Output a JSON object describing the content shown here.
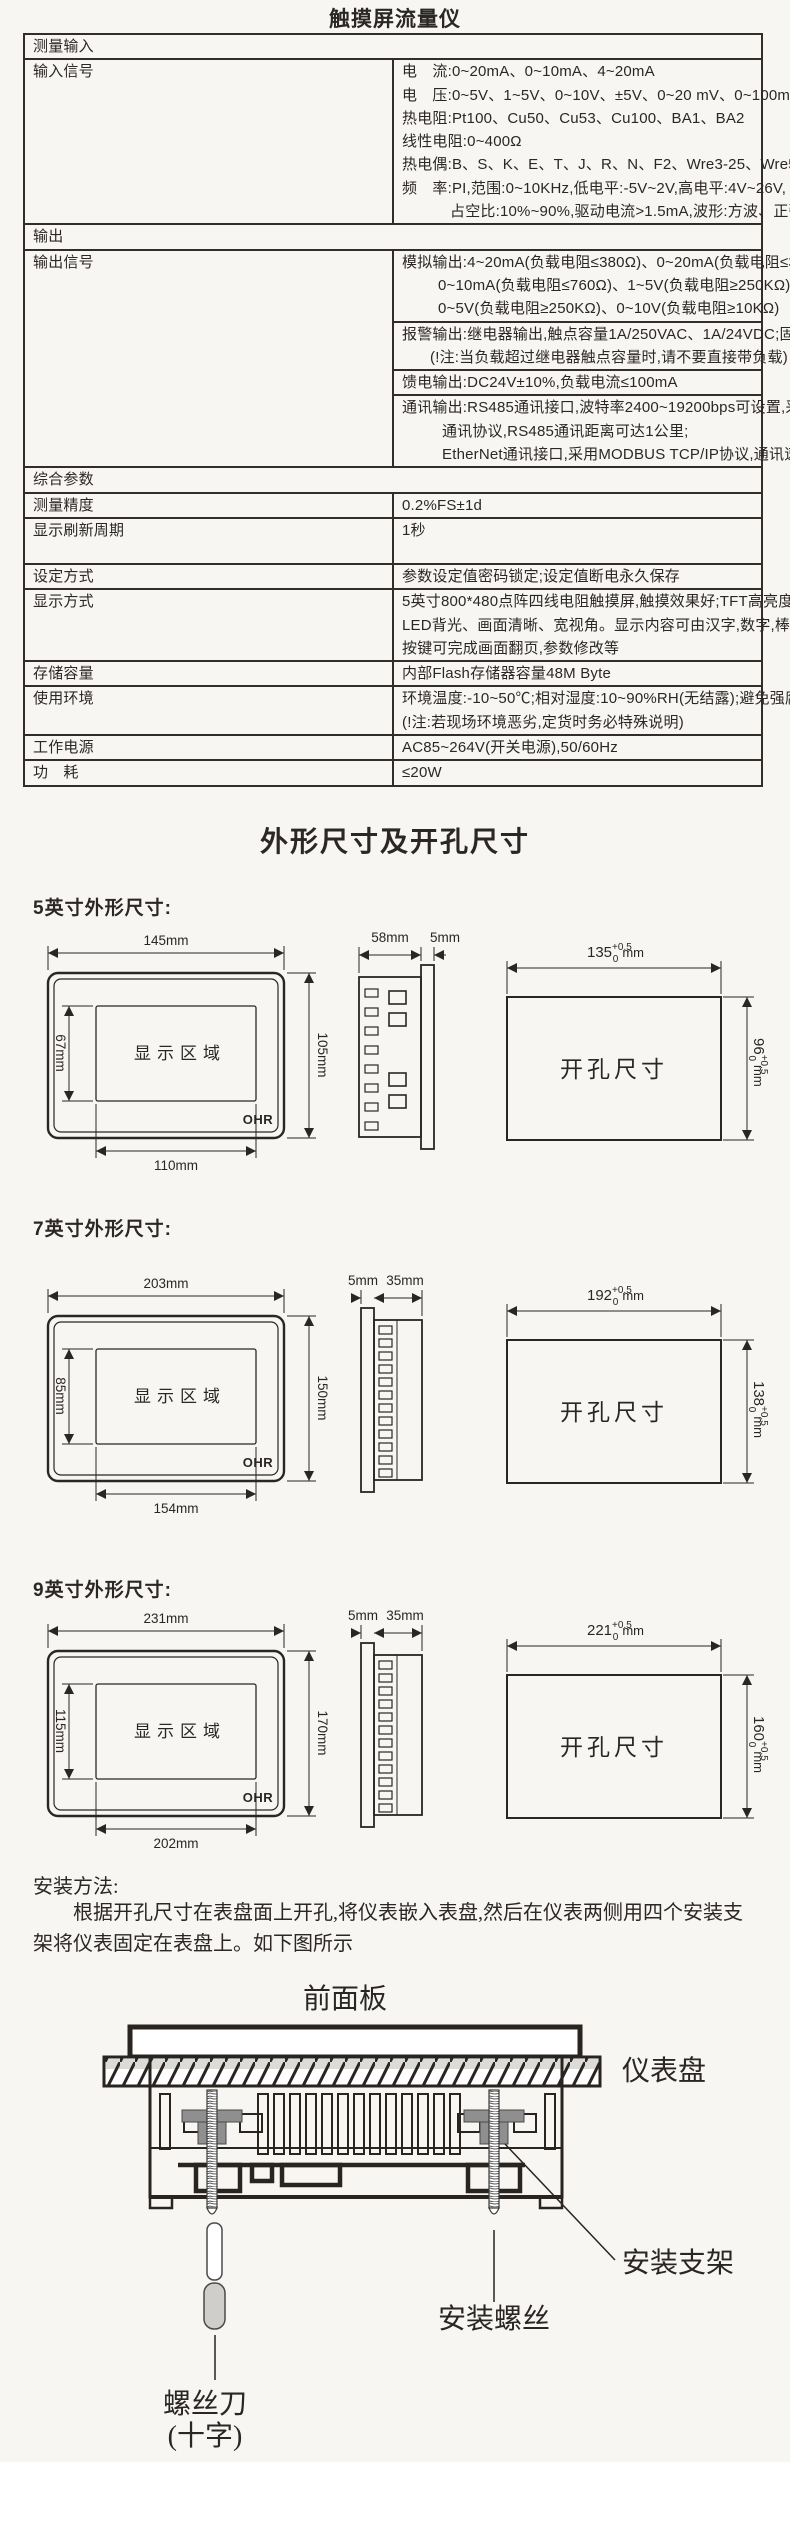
{
  "title": "触摸屏流量仪",
  "spec": {
    "sec1": "测量输入",
    "row_input": {
      "label": "输入信号",
      "lines": [
        "电　流:0~20mA、0~10mA、4~20mA",
        "电　压:0~5V、1~5V、0~10V、±5V、0~20 mV、0~100mV、±20mV、±100mV",
        "热电阻:Pt100、Cu50、Cu53、Cu100、BA1、BA2",
        "线性电阻:0~400Ω",
        "热电偶:B、S、K、E、T、J、R、N、F2、Wre3-25、Wre5-26",
        "频　率:PI,范围:0~10KHz,低电平:-5V~2V,高电平:4V~26V,",
        "占空比:10%~90%,驱动电流>1.5mA,波形:方波、正弦波、三角波等"
      ]
    },
    "sec2": "输出",
    "row_output": {
      "label": "输出信号",
      "sub1": [
        "模拟输出:4~20mA(负载电阻≤380Ω)、0~20mA(负载电阻≤380Ω)、",
        "0~10mA(负载电阻≤760Ω)、1~5V(负载电阻≥250KΩ)、",
        "0~5V(负载电阻≥250KΩ)、0~10V(负载电阻≥10KΩ)"
      ],
      "sub2": [
        "报警输出:继电器输出,触点容量1A/250VAC、1A/24VDC;固态继电器输出,12V/30mA",
        "(!注:当负载超过继电器触点容量时,请不要直接带负载)"
      ],
      "sub3": "馈电输出:DC24V±10%,负载电流≤100mA",
      "sub4": [
        "通讯输出:RS485通讯接口,波特率2400~19200bps可设置,采用标准MODBUS RTU",
        "通讯协议,RS485通讯距离可达1公里;",
        "EtherNet通讯接口,采用MODBUS TCP/IP协议,通讯速率为10/100M自适应。"
      ]
    },
    "sec3": "综合参数",
    "row_acc": {
      "label": "测量精度",
      "value": "0.2%FS±1d"
    },
    "row_refresh": {
      "label": "显示刷新周期",
      "value": "1秒"
    },
    "row_set": {
      "label": "设定方式",
      "value": "参数设定值密码锁定;设定值断电永久保存"
    },
    "row_disp": {
      "label": "显示方式",
      "lines": [
        "5英寸800*480点阵四线电阻触摸屏,触摸效果好;TFT高亮度彩色图形液晶显示,",
        "LED背光、画面清晰、宽视角。显示内容可由汉字,数字,棒图等组成,通过触摸",
        "按键可完成画面翻页,参数修改等"
      ]
    },
    "row_store": {
      "label": "存储容量",
      "value": "内部Flash存储器容量48M Byte"
    },
    "row_env": {
      "label": "使用环境",
      "lines": [
        "环境温度:-10~50℃;相对湿度:10~90%RH(无结露);避免强腐蚀气体。",
        "(!注:若现场环境恶劣,定货时务必特殊说明)"
      ]
    },
    "row_power": {
      "label": "工作电源",
      "value": "AC85~264V(开关电源),50/60Hz"
    },
    "row_cons": {
      "label": "功　耗",
      "value": "≤20W"
    }
  },
  "dims": {
    "title": "外形尺寸及开孔尺寸",
    "tol_plus": "+0.5",
    "tol_zero": "0",
    "tol_unit": "mm",
    "models": [
      {
        "heading": "5英寸外形尺寸:",
        "front_w": "145mm",
        "front_h": "105mm",
        "disp_h": "67mm",
        "disp_w": "110mm",
        "display_label": "显示区域",
        "logo": "OHR",
        "side_left": "58mm",
        "side_right": "5mm",
        "cut_w": "135",
        "cut_h": "96",
        "cut_label": "开孔尺寸"
      },
      {
        "heading": "7英寸外形尺寸:",
        "front_w": "203mm",
        "front_h": "150mm",
        "disp_h": "85mm",
        "disp_w": "154mm",
        "display_label": "显示区域",
        "logo": "OHR",
        "side_left": "5mm",
        "side_right": "35mm",
        "cut_w": "192",
        "cut_h": "138",
        "cut_label": "开孔尺寸"
      },
      {
        "heading": "9英寸外形尺寸:",
        "front_w": "231mm",
        "front_h": "170mm",
        "disp_h": "115mm",
        "disp_w": "202mm",
        "display_label": "显示区域",
        "logo": "OHR",
        "side_left": "5mm",
        "side_right": "35mm",
        "cut_w": "221",
        "cut_h": "160",
        "cut_label": "开孔尺寸"
      }
    ]
  },
  "install": {
    "heading": "安装方法:",
    "para": "根据开孔尺寸在表盘面上开孔,将仪表嵌入表盘,然后在仪表两侧用四个安装支架将仪表固定在表盘上。如下图所示",
    "front_panel": "前面板",
    "panel": "仪表盘",
    "bracket": "安装支架",
    "screw": "安装螺丝",
    "driver1": "螺丝刀",
    "driver2": "(十字)"
  }
}
